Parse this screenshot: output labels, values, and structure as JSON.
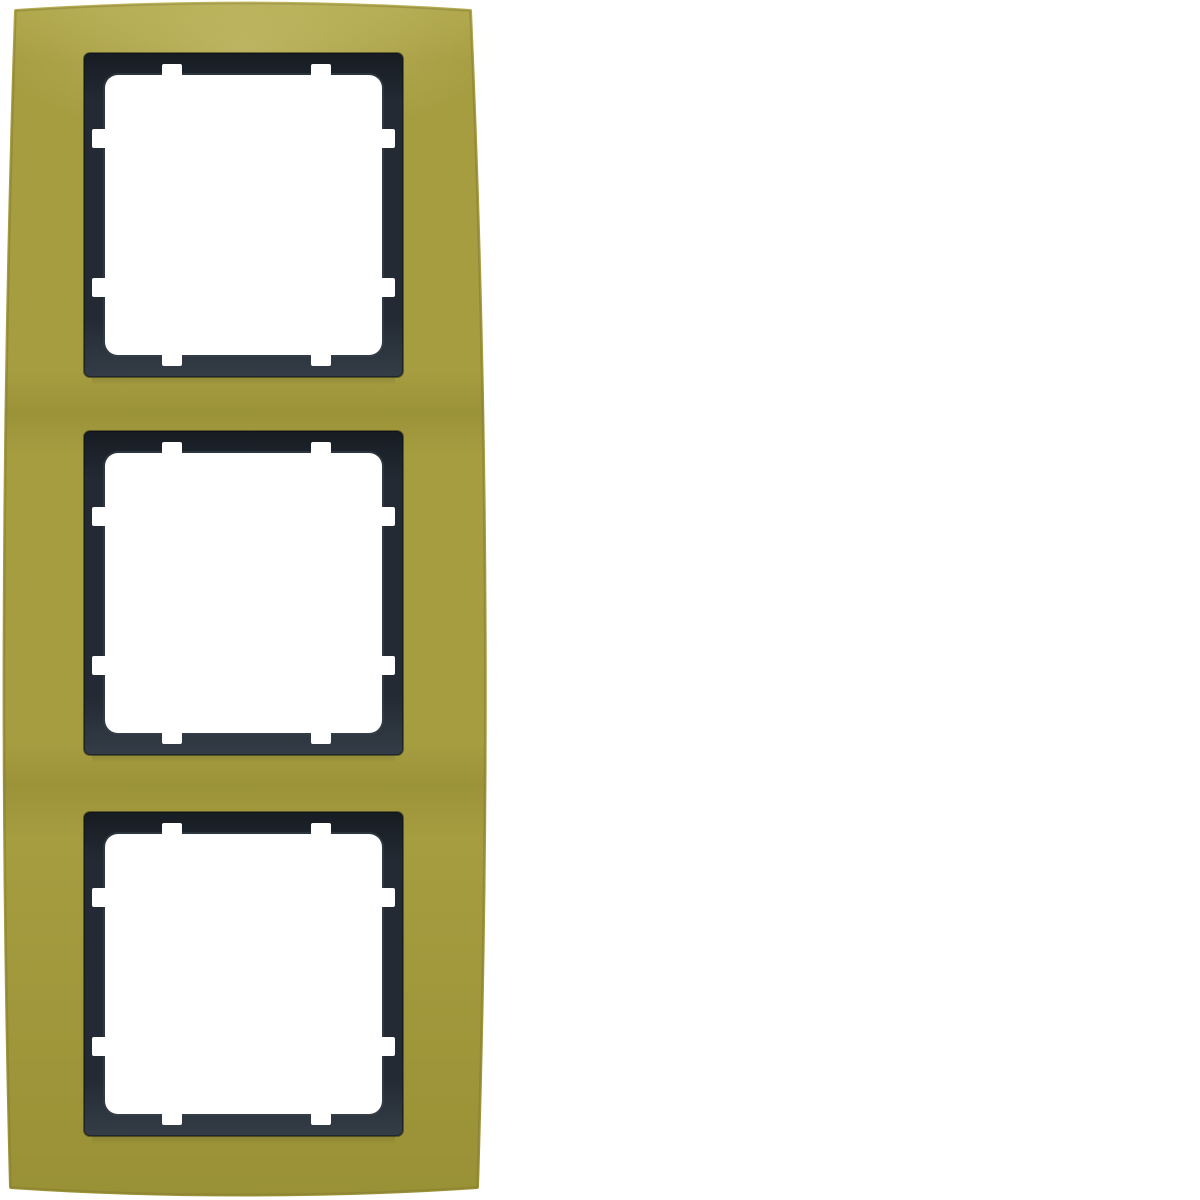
{
  "image": {
    "type": "product-photo",
    "description": "Vertical three-gang cover frame for flush-mounted switch inserts, gold-olive anodised aluminium front plate with dark anthracite inner module frames and white square apertures, photographed on a plain white background",
    "background": "#ffffff"
  },
  "product": {
    "window_count": 3,
    "windows": [
      {
        "name": "module-window-1"
      },
      {
        "name": "module-window-2"
      },
      {
        "name": "module-window-3"
      }
    ],
    "notches_per_window": 8
  },
  "colors": {
    "background": "#ffffff",
    "plate_top": "#b3aa4f",
    "plate_main": "#a69c40",
    "plate_band": "#9c9339",
    "plate_bottom": "#9a9136",
    "plate_edge": "#847c31",
    "frame_top": "#171c23",
    "frame_main": "#232a33",
    "frame_bottom": "#343d47",
    "frame_bevel": "#3a434d",
    "aperture": "#ffffff",
    "sheen": "#ffffc8",
    "shadow": "#000000"
  }
}
